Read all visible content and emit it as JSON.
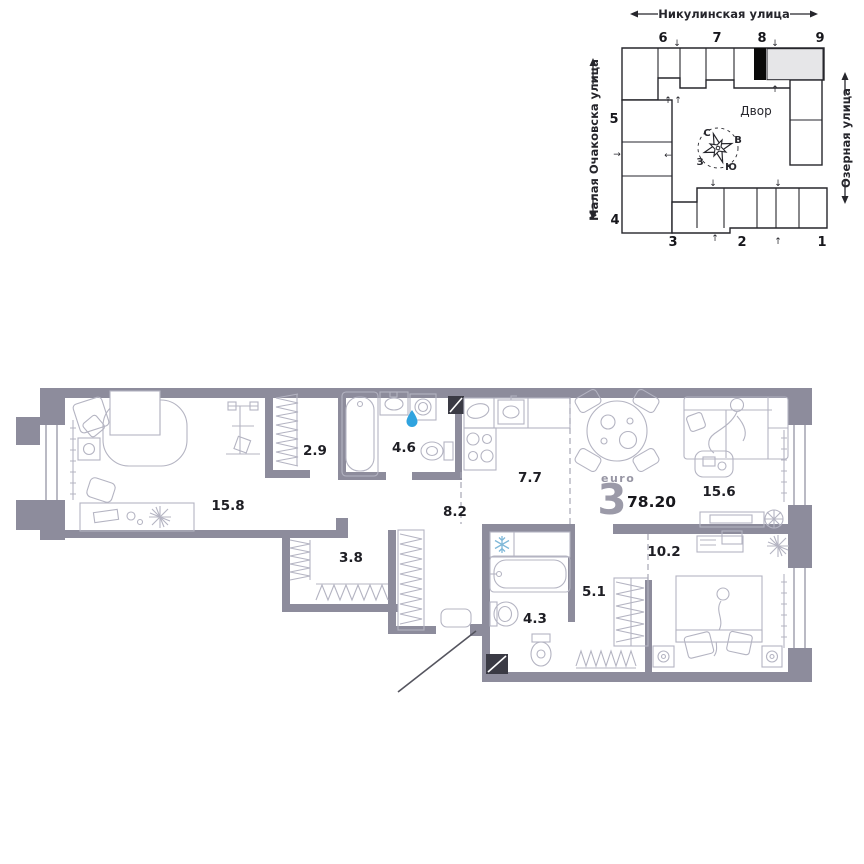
{
  "site_plan": {
    "streets": {
      "top": "Никулинская улица",
      "left": "Малая Очаковска улица",
      "right": "Озерная улица"
    },
    "courtyard_label": "Двор",
    "compass": {
      "n": "С",
      "e": "В",
      "s": "Ю",
      "w": "З"
    },
    "buildings": {
      "b1": "1",
      "b2": "2",
      "b3": "3",
      "b4": "4",
      "b5": "5",
      "b6": "6",
      "b7": "7",
      "b8": "8",
      "b9": "9"
    },
    "arrows": {
      "up": "↑",
      "down": "↓",
      "left": "←",
      "right": "→"
    }
  },
  "apartment": {
    "type_prefix": "euro",
    "type_number": "3",
    "total_area": "78.20",
    "rooms": [
      {
        "name": "bedroom-main",
        "area": "15.8"
      },
      {
        "name": "wardrobe",
        "area": "2.9"
      },
      {
        "name": "bathroom-main",
        "area": "4.6"
      },
      {
        "name": "hallway",
        "area": "8.2"
      },
      {
        "name": "kitchen",
        "area": "7.7"
      },
      {
        "name": "living-room",
        "area": "15.6"
      },
      {
        "name": "walk-in-closet",
        "area": "3.8"
      },
      {
        "name": "hall-entry",
        "area": "5.1"
      },
      {
        "name": "bathroom-small",
        "area": "4.3"
      },
      {
        "name": "bedroom-second",
        "area": "10.2"
      }
    ]
  },
  "colors": {
    "wall": "#8d8c9c",
    "furniture": "#b4b4c2",
    "outline": "#26262c",
    "highlight_black": "#0a0a0a",
    "muted_building": "#e6e6e8",
    "vent_dark": "#3a3a44",
    "water_drop": "#2fa3df",
    "snowflake": "#7fb8d8"
  }
}
